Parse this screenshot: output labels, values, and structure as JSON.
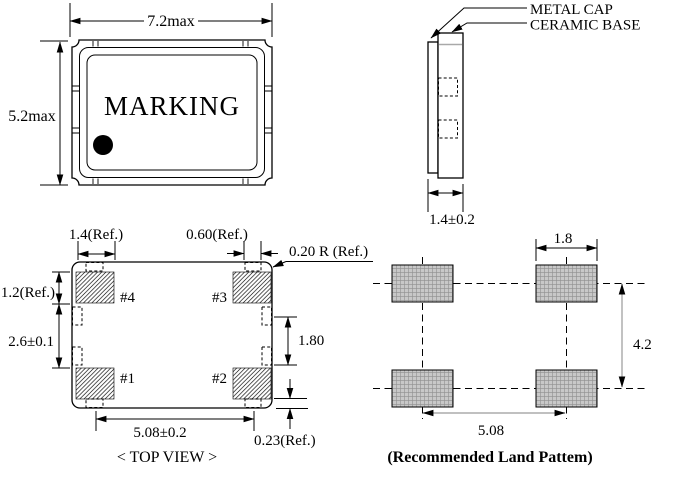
{
  "drawing": {
    "pad_fill": "#c8c8c8",
    "pad_grid_line": "#8f8f8f",
    "gray_dim_color": "#9a9a9a",
    "line_color": "#000000"
  },
  "outline_view": {
    "marking": "MARKING",
    "width_dim": "7.2max",
    "height_dim": "5.2max"
  },
  "side_view": {
    "metal_cap_label": "METAL CAP",
    "ceramic_base_label": "CERAMIC BASE",
    "thickness_dim": "1.4±0.2"
  },
  "top_view": {
    "caption": "< TOP VIEW >",
    "pad_width_dim": "1.4(Ref.)",
    "notch_width_dim": "0.60(Ref.)",
    "corner_radius_dim": "0.20 R (Ref.)",
    "pad_height_dim": "1.2(Ref.)",
    "inner_gap_dim": "2.6±0.1",
    "side_notch_pitch_dim": "1.80",
    "pad_pitch_dim": "5.08±0.2",
    "edge_margin_dim": "0.23(Ref.)",
    "pins": {
      "p1": "#1",
      "p2": "#2",
      "p3": "#3",
      "p4": "#4"
    }
  },
  "land_pattern": {
    "caption": "(Recommended Land Pattem)",
    "pad_width_dim": "1.8",
    "row_pitch_dim": "4.2",
    "col_pitch_dim": "5.08"
  }
}
